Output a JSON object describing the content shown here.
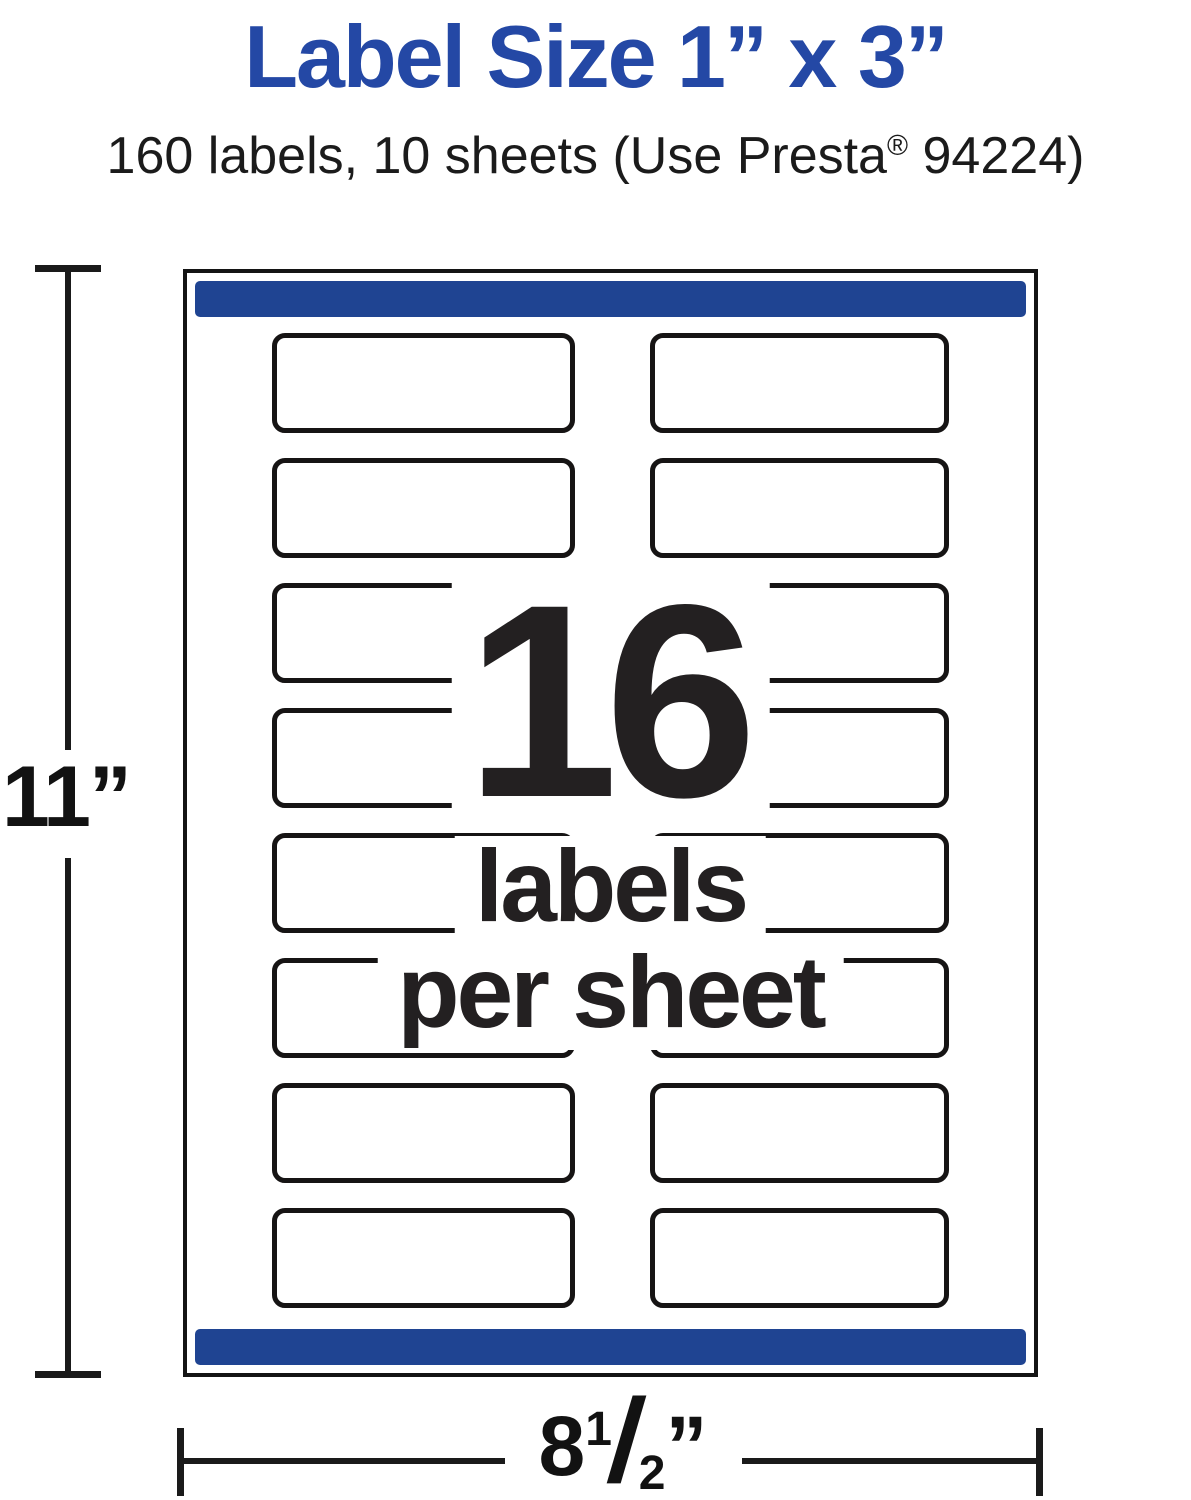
{
  "header": {
    "title": "Label Size 1” x 3”",
    "subtitle_pre": "160 labels, 10 sheets (Use Presta",
    "subtitle_reg": "®",
    "subtitle_post": " 94224)"
  },
  "sheet": {
    "rows": 8,
    "columns": 2,
    "center_callout": {
      "count": "16",
      "line2": "labels",
      "line3": "per sheet"
    }
  },
  "dimensions": {
    "height": "11”",
    "width": {
      "whole": "8",
      "numerator": "1",
      "slash": "/",
      "denominator": "2",
      "unit": "”"
    }
  },
  "colors": {
    "title_blue": "#2448a5",
    "bar_blue": "#1f4492",
    "ink": "#232021",
    "line": "#1a1a1a"
  }
}
